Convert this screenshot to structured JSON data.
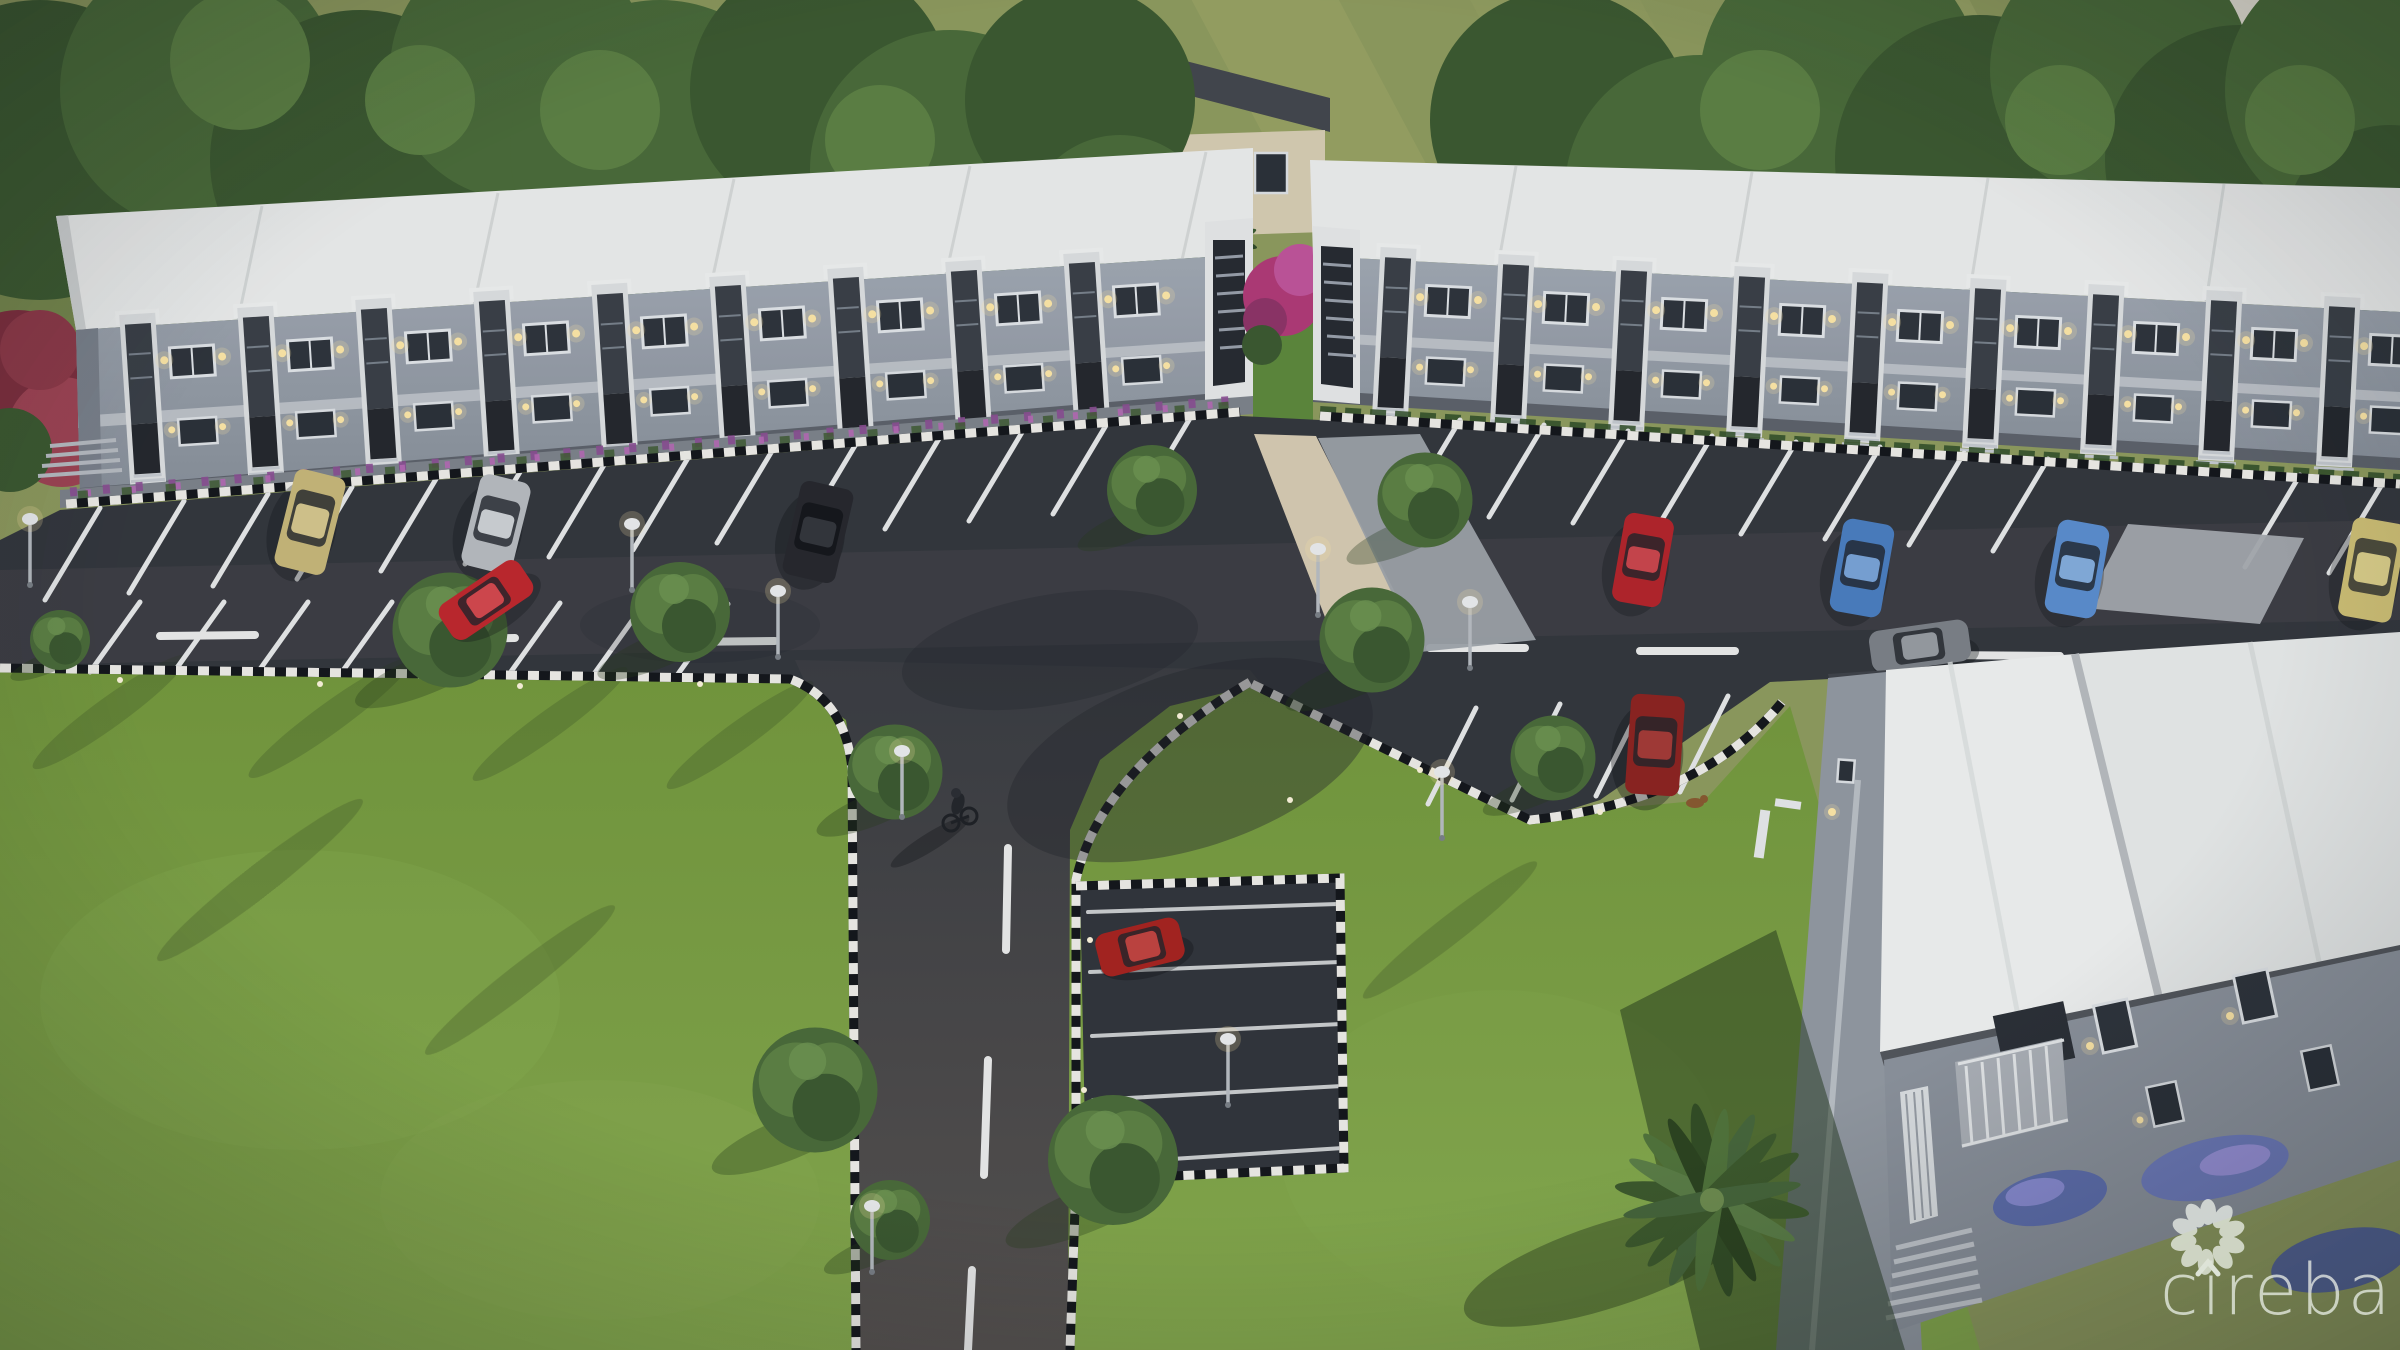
{
  "watermark": {
    "icon": "cireba-pinwheel-logo",
    "text": "cireba",
    "color": "#edf1ea"
  },
  "palette": {
    "field_green": "#8f9c5e",
    "lawn_green": "#7aa040",
    "lawn_light": "#8ab04f",
    "tree_green": "#4a6c39",
    "asphalt_parking": "#33373d",
    "asphalt_road": "#4d4c4d",
    "road_vertical": "#575350",
    "marking_white": "#e8eaea",
    "roof_white": "#eef0ef",
    "facade_gray": "#99a1ab",
    "facade_lower": "#8d959f",
    "stair_panel_dark": "#3a4047",
    "sidewalk_gray": "#7e848c",
    "walkway_beige": "#d9cdb4",
    "apron_gray": "#9fa4ab",
    "flower_pink": "#b23a78",
    "flowerbed_purple": "#8c4f93",
    "window_warm_light": "#f6e3a1",
    "background_house_wall": "#d8cfb4",
    "background_house_roof": "#43474d",
    "background_building_wall": "#e9e5d8",
    "curb_checker_dark": "#14171b",
    "curb_checker_light": "#f0efe9"
  },
  "scene": {
    "setting": "aerial dusk rendering of a two-storey townhouse development with front parking, T-junction access road, checkered curbs and landscaped lawns",
    "buildings": [
      {
        "name": "left-townhouse-row",
        "storeys": 2,
        "roof": "flat white",
        "walls": "gray",
        "units_visible": 9
      },
      {
        "name": "right-townhouse-row",
        "storeys": 2,
        "roof": "flat white",
        "walls": "gray",
        "units_visible": 9
      },
      {
        "name": "foreground-townhouse-row",
        "storeys": 2,
        "roof": "flat white",
        "walls": "gray",
        "features": "balcony, entry stairs, purple flowerbeds"
      },
      {
        "name": "background-house",
        "roof": "dark gable",
        "walls": "beige"
      },
      {
        "name": "background-white-building",
        "walls": "cream with brown trim"
      }
    ],
    "vehicles": [
      {
        "label": "tan-van",
        "color": "tan",
        "hex": "#c9b97a",
        "state": "parked"
      },
      {
        "label": "silver-car",
        "color": "silver",
        "hex": "#b9bdc1",
        "state": "parked"
      },
      {
        "label": "red-car-driving",
        "color": "red",
        "hex": "#c0272d",
        "state": "driving"
      },
      {
        "label": "black-suv",
        "color": "black",
        "hex": "#26282d",
        "state": "parked"
      },
      {
        "label": "red-car-parked",
        "color": "red",
        "hex": "#b5242b",
        "state": "parked"
      },
      {
        "label": "blue-car-1",
        "color": "blue",
        "hex": "#4a7fc1",
        "state": "parked"
      },
      {
        "label": "blue-car-2",
        "color": "blue",
        "hex": "#5b8fd0",
        "state": "parked"
      },
      {
        "label": "yellow-van",
        "color": "pale yellow",
        "hex": "#d2c377",
        "state": "parked"
      },
      {
        "label": "gray-sedan-driving",
        "color": "gray",
        "hex": "#7d8288",
        "state": "driving"
      },
      {
        "label": "dark-red-suv",
        "color": "dark red",
        "hex": "#8e2320",
        "state": "parked"
      },
      {
        "label": "red-hatchback",
        "color": "red",
        "hex": "#a8231f",
        "state": "parked"
      }
    ],
    "features": {
      "round_trees": 12,
      "palm_trees": 1,
      "flowering_trees": 2,
      "street_lamps": 9,
      "cyclist": 1,
      "dog": 1,
      "curbs": "black-white checkered",
      "road_markings": "white dashed centerline, angled parking stalls"
    }
  }
}
